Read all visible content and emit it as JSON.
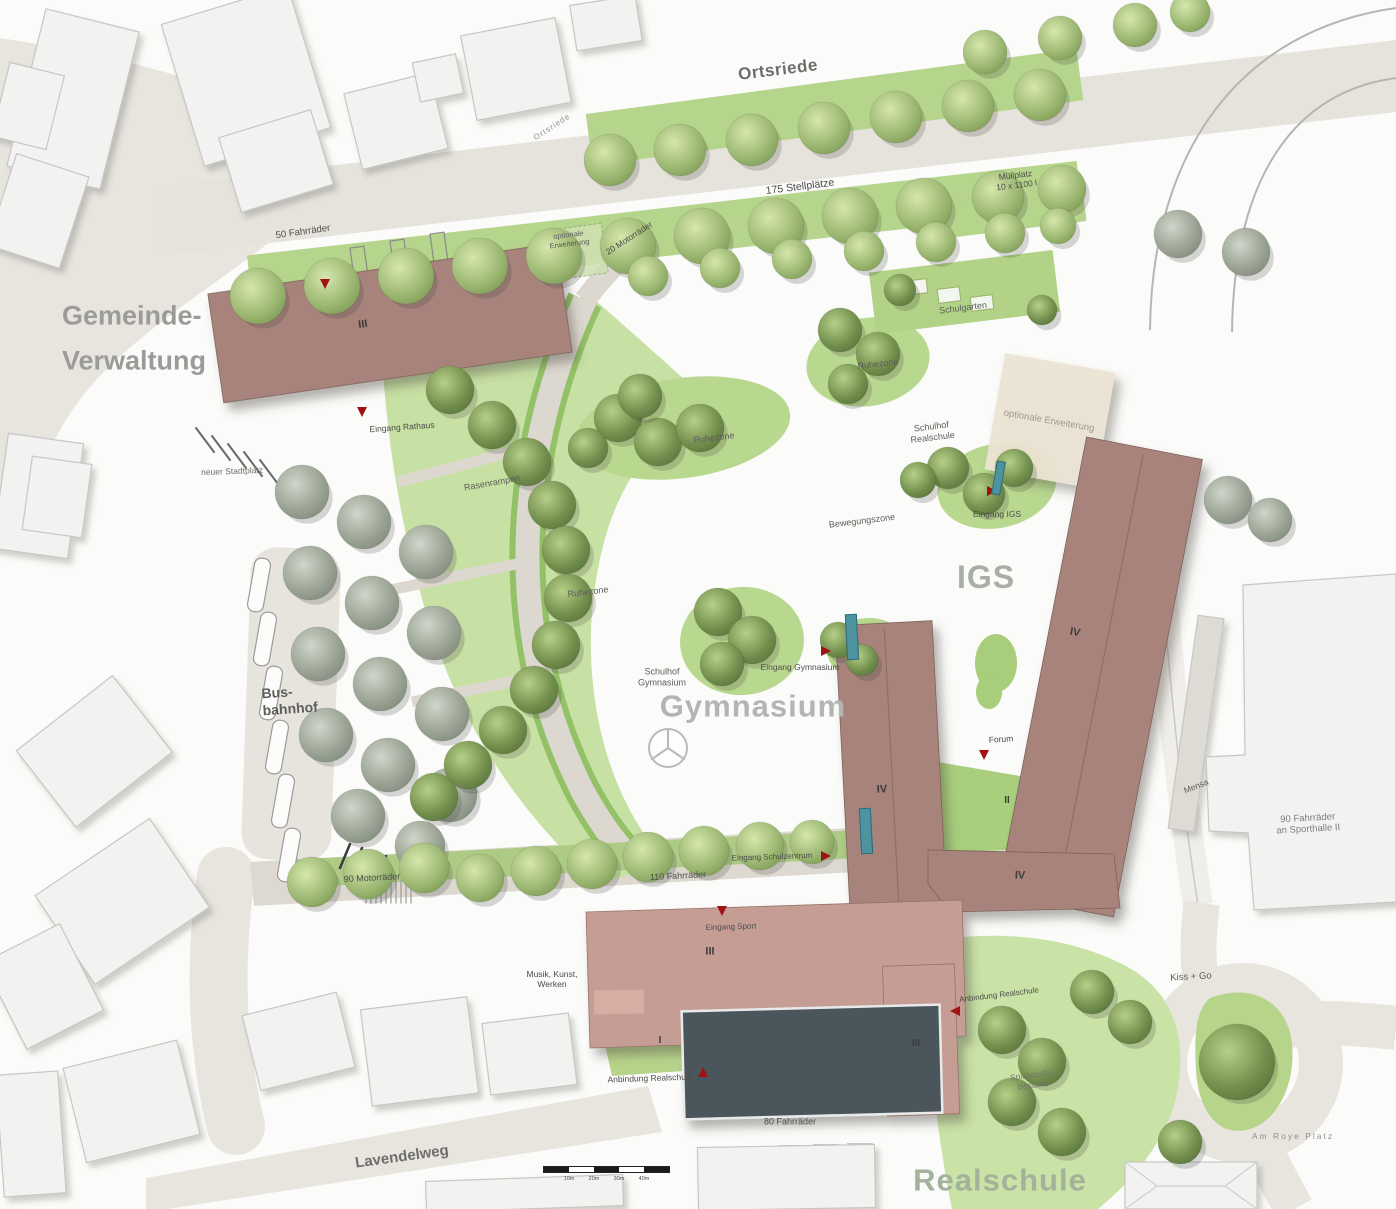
{
  "map_title": "Schulzentrum Lageplan",
  "colors": {
    "building_new": "#a7837b",
    "building_annex": "#c59d95",
    "sports_hall_dark": "#4b565c",
    "green_field": "#c7e0a4",
    "entry_marker_red": "#a11212",
    "entry_door_teal": "#4e93a0",
    "existing_building": "#f2f2f1",
    "road": "#e8e5df"
  },
  "labels": [
    {
      "n": "street-ortsriede",
      "t": "Ortsriede",
      "x": 778,
      "y": 70,
      "s": 17,
      "c": "#6d6d6b",
      "r": -7,
      "w": 700,
      "ls": 0.5
    },
    {
      "n": "street-ortsriede-small",
      "t": "Ortsriede",
      "x": 552,
      "y": 127,
      "s": 8,
      "c": "#8f8f8d",
      "r": -33,
      "ls": 1
    },
    {
      "n": "parking-stellplaetze",
      "t": "175 Stellplätze",
      "x": 800,
      "y": 187,
      "s": 10.5,
      "c": "#4c4c4a",
      "r": -7
    },
    {
      "n": "muellplatz",
      "t": "Müllplatz\n10 x 1100 l",
      "x": 1016,
      "y": 180,
      "s": 8.5,
      "c": "#4c4c4a",
      "r": -7
    },
    {
      "n": "fahrraeder-50",
      "t": "50 Fahrräder",
      "x": 303,
      "y": 232,
      "s": 9.5,
      "c": "#4c4c4a",
      "r": -8
    },
    {
      "n": "optionale-erweiterung-rathaus",
      "t": "optionale\nErweiterung",
      "x": 569,
      "y": 240,
      "s": 7.5,
      "c": "#5c5c5a",
      "r": -7
    },
    {
      "n": "motorraeder-20",
      "t": "20 Motorräder",
      "x": 629,
      "y": 238,
      "s": 8.5,
      "c": "#4c4c4a",
      "r": -33
    },
    {
      "n": "gemeinde-verwaltung",
      "t": "Gemeinde-\nVerwaltung",
      "x": 62,
      "y": 338,
      "s": 27,
      "c": "#9b9b99",
      "r": 0,
      "w": 700,
      "a": "l",
      "lh": 1.65
    },
    {
      "n": "rathaus-level",
      "t": "III",
      "x": 363,
      "y": 325,
      "s": 11,
      "c": "#3c3c3a",
      "r": -8,
      "w": 700
    },
    {
      "n": "eingang-rathaus",
      "t": "Eingang Rathaus",
      "x": 402,
      "y": 427,
      "s": 8.5,
      "c": "#4c4c4a",
      "r": -4
    },
    {
      "n": "neuer-stadtplatz",
      "t": "neuer Stadtplatz",
      "x": 232,
      "y": 471,
      "s": 8.5,
      "c": "#6d6d6b",
      "r": -2
    },
    {
      "n": "schulgarten",
      "t": "Schulgarten",
      "x": 963,
      "y": 308,
      "s": 9,
      "c": "#5c5c5a",
      "r": -7
    },
    {
      "n": "ruhezone-nord",
      "t": "Ruhezone",
      "x": 878,
      "y": 364,
      "s": 9,
      "c": "#5c5c5a",
      "r": -7
    },
    {
      "n": "optionale-erweiterung-igs",
      "t": "optionale Erweiterung",
      "x": 1049,
      "y": 421,
      "s": 9.5,
      "c": "#9d9a8d",
      "r": 10
    },
    {
      "n": "schulhof-realschule",
      "t": "Schulhof\nRealschule",
      "x": 932,
      "y": 432,
      "s": 9,
      "c": "#5c5c5a",
      "r": -7
    },
    {
      "n": "eingang-igs",
      "t": "Eingang IGS",
      "x": 997,
      "y": 514,
      "s": 8.5,
      "c": "#4c4c4a",
      "r": 0
    },
    {
      "n": "igs-title",
      "t": "IGS",
      "x": 986,
      "y": 578,
      "s": 32,
      "c": "#a9aea9",
      "r": 0,
      "w": 700,
      "ls": 1
    },
    {
      "n": "bewegungszone",
      "t": "Bewegungszone",
      "x": 862,
      "y": 521,
      "s": 9,
      "c": "#5c5c5a",
      "r": -7
    },
    {
      "n": "ruhezone-mitte",
      "t": "Ruhezone",
      "x": 714,
      "y": 438,
      "s": 9,
      "c": "#5c5c5a",
      "r": -7
    },
    {
      "n": "ruhezone-west",
      "t": "Ruhezone",
      "x": 588,
      "y": 592,
      "s": 9,
      "c": "#5c5c5a",
      "r": -7
    },
    {
      "n": "rasenrampen",
      "t": "Rasenrampen",
      "x": 492,
      "y": 483,
      "s": 9,
      "c": "#5c5c5a",
      "r": -10
    },
    {
      "n": "schulhof-gymnasium",
      "t": "Schulhof\nGymnasium",
      "x": 662,
      "y": 677,
      "s": 9,
      "c": "#5c5c5a",
      "r": 0
    },
    {
      "n": "eingang-gymnasium",
      "t": "Eingang Gymnasium",
      "x": 800,
      "y": 667,
      "s": 8.5,
      "c": "#4c4c4a",
      "r": 0
    },
    {
      "n": "gymnasium-title",
      "t": "Gymnasium",
      "x": 753,
      "y": 707,
      "s": 31,
      "c": "#b4b4b2",
      "r": 0,
      "w": 700,
      "ls": 1
    },
    {
      "n": "gymnasium-level",
      "t": "IV",
      "x": 882,
      "y": 790,
      "s": 11,
      "c": "#3c3c3a",
      "r": -3,
      "w": 700
    },
    {
      "n": "hof-level",
      "t": "II",
      "x": 1007,
      "y": 801,
      "s": 10,
      "c": "#3c3c3a",
      "r": 0,
      "w": 700
    },
    {
      "n": "forum",
      "t": "Forum",
      "x": 1001,
      "y": 739,
      "s": 8.5,
      "c": "#4c4c4a",
      "r": -4
    },
    {
      "n": "querbau-level",
      "t": "IV",
      "x": 1020,
      "y": 876,
      "s": 11,
      "c": "#3c3c3a",
      "r": 2,
      "w": 700
    },
    {
      "n": "igs-level",
      "t": "IV",
      "x": 1075,
      "y": 633,
      "s": 11,
      "c": "#3c3c3a",
      "r": 11,
      "w": 700
    },
    {
      "n": "mensa",
      "t": "Mensa",
      "x": 1196,
      "y": 786,
      "s": 8.5,
      "c": "#5c5c5a",
      "r": -22
    },
    {
      "n": "fahrraeder-sporthalle",
      "t": "90 Fahrräder\nan Sporthalle II",
      "x": 1308,
      "y": 824,
      "s": 9.5,
      "c": "#7e7e7c",
      "r": -3
    },
    {
      "n": "busbahnhof",
      "t": "Bus-\nbahnhof",
      "x": 262,
      "y": 700,
      "s": 14,
      "c": "#5f5f5d",
      "r": -4,
      "w": 700,
      "a": "l"
    },
    {
      "n": "motorraeder-90",
      "t": "90 Motorräder",
      "x": 372,
      "y": 878,
      "s": 9,
      "c": "#4c4c4a",
      "r": -3
    },
    {
      "n": "fahrraeder-110",
      "t": "110 Fahrräder",
      "x": 678,
      "y": 876,
      "s": 9,
      "c": "#4c4c4a",
      "r": -3
    },
    {
      "n": "eingang-schulzentrum",
      "t": "Eingang Schulzentrum",
      "x": 772,
      "y": 857,
      "s": 8,
      "c": "#4c4c4a",
      "r": -2
    },
    {
      "n": "eingang-sport",
      "t": "Eingang Sport",
      "x": 731,
      "y": 927,
      "s": 8,
      "c": "#4c4c4a",
      "r": -2
    },
    {
      "n": "musik-kunst-werken",
      "t": "Musik, Kunst,\nWerken",
      "x": 552,
      "y": 979,
      "s": 8.5,
      "c": "#4c4c4a",
      "r": 0
    },
    {
      "n": "musikbau-level",
      "t": "III",
      "x": 710,
      "y": 952,
      "s": 11,
      "c": "#3c3c3a",
      "r": 0,
      "w": 700
    },
    {
      "n": "anbau-level",
      "t": "III",
      "x": 916,
      "y": 1044,
      "s": 10,
      "c": "#3c3c3a",
      "r": 0,
      "w": 700
    },
    {
      "n": "deck-level",
      "t": "I",
      "x": 660,
      "y": 1041,
      "s": 10,
      "c": "#3c3c3a",
      "r": 0,
      "w": 700
    },
    {
      "n": "anbindung-realschule-west",
      "t": "Anbindung Realschule",
      "x": 650,
      "y": 1078,
      "s": 8.5,
      "c": "#4c4c4a",
      "r": -2
    },
    {
      "n": "fahrraeder-80",
      "t": "80 Fahrräder",
      "x": 790,
      "y": 1122,
      "s": 9,
      "c": "#4c4c4a",
      "r": 0
    },
    {
      "n": "anbindung-realschule-ost",
      "t": "Anbindung Realschule",
      "x": 999,
      "y": 995,
      "s": 8,
      "c": "#4c4c4a",
      "r": -7
    },
    {
      "n": "kiss-go",
      "t": "Kiss + Go",
      "x": 1191,
      "y": 977,
      "s": 9.5,
      "c": "#5c5c5a",
      "r": -3
    },
    {
      "n": "spielstrasse-bestand",
      "t": "Spielstraße\nBestand",
      "x": 1032,
      "y": 1080,
      "s": 8.5,
      "c": "#73786d",
      "r": -7
    },
    {
      "n": "am-roye-platz",
      "t": "Am Roye Platz",
      "x": 1293,
      "y": 1136,
      "s": 8.5,
      "c": "#8e8e8c",
      "r": 0,
      "ls": 2
    },
    {
      "n": "realschule-title",
      "t": "Realschule",
      "x": 1000,
      "y": 1181,
      "s": 31,
      "c": "#a2b29b",
      "r": 0,
      "w": 700,
      "ls": 1
    },
    {
      "n": "street-lavendelweg",
      "t": "Lavendelweg",
      "x": 402,
      "y": 1157,
      "s": 15,
      "c": "#6d6d6b",
      "r": -8,
      "w": 700
    }
  ],
  "entrance_markers": [
    {
      "n": "entry-marker-rathaus-nord",
      "x": 325,
      "y": 284,
      "dir": "down"
    },
    {
      "n": "entry-marker-rathaus",
      "x": 362,
      "y": 412,
      "dir": "down"
    },
    {
      "n": "entry-marker-gymnasium",
      "x": 826,
      "y": 651,
      "dir": "right"
    },
    {
      "n": "entry-marker-igs",
      "x": 992,
      "y": 491,
      "dir": "right"
    },
    {
      "n": "entry-marker-forum",
      "x": 984,
      "y": 755,
      "dir": "down"
    },
    {
      "n": "entry-marker-schulzentrum",
      "x": 826,
      "y": 856,
      "dir": "right"
    },
    {
      "n": "entry-marker-sport",
      "x": 722,
      "y": 911,
      "dir": "down"
    },
    {
      "n": "entry-marker-anbindung-west",
      "x": 703,
      "y": 1072,
      "dir": "up"
    },
    {
      "n": "entry-marker-anbindung-ost",
      "x": 955,
      "y": 1011,
      "dir": "left"
    }
  ],
  "entrance_doors": [
    {
      "n": "door-gymnasium",
      "x": 852,
      "y": 637,
      "w": 12,
      "h": 46,
      "r": -3
    },
    {
      "n": "door-schulzentrum",
      "x": 866,
      "y": 831,
      "w": 12,
      "h": 46,
      "r": -3
    },
    {
      "n": "door-igs",
      "x": 998,
      "y": 478,
      "w": 9,
      "h": 34,
      "r": 10
    }
  ],
  "scale_bar": {
    "ticks": [
      "10m",
      "20m",
      "30m",
      "40m"
    ]
  }
}
